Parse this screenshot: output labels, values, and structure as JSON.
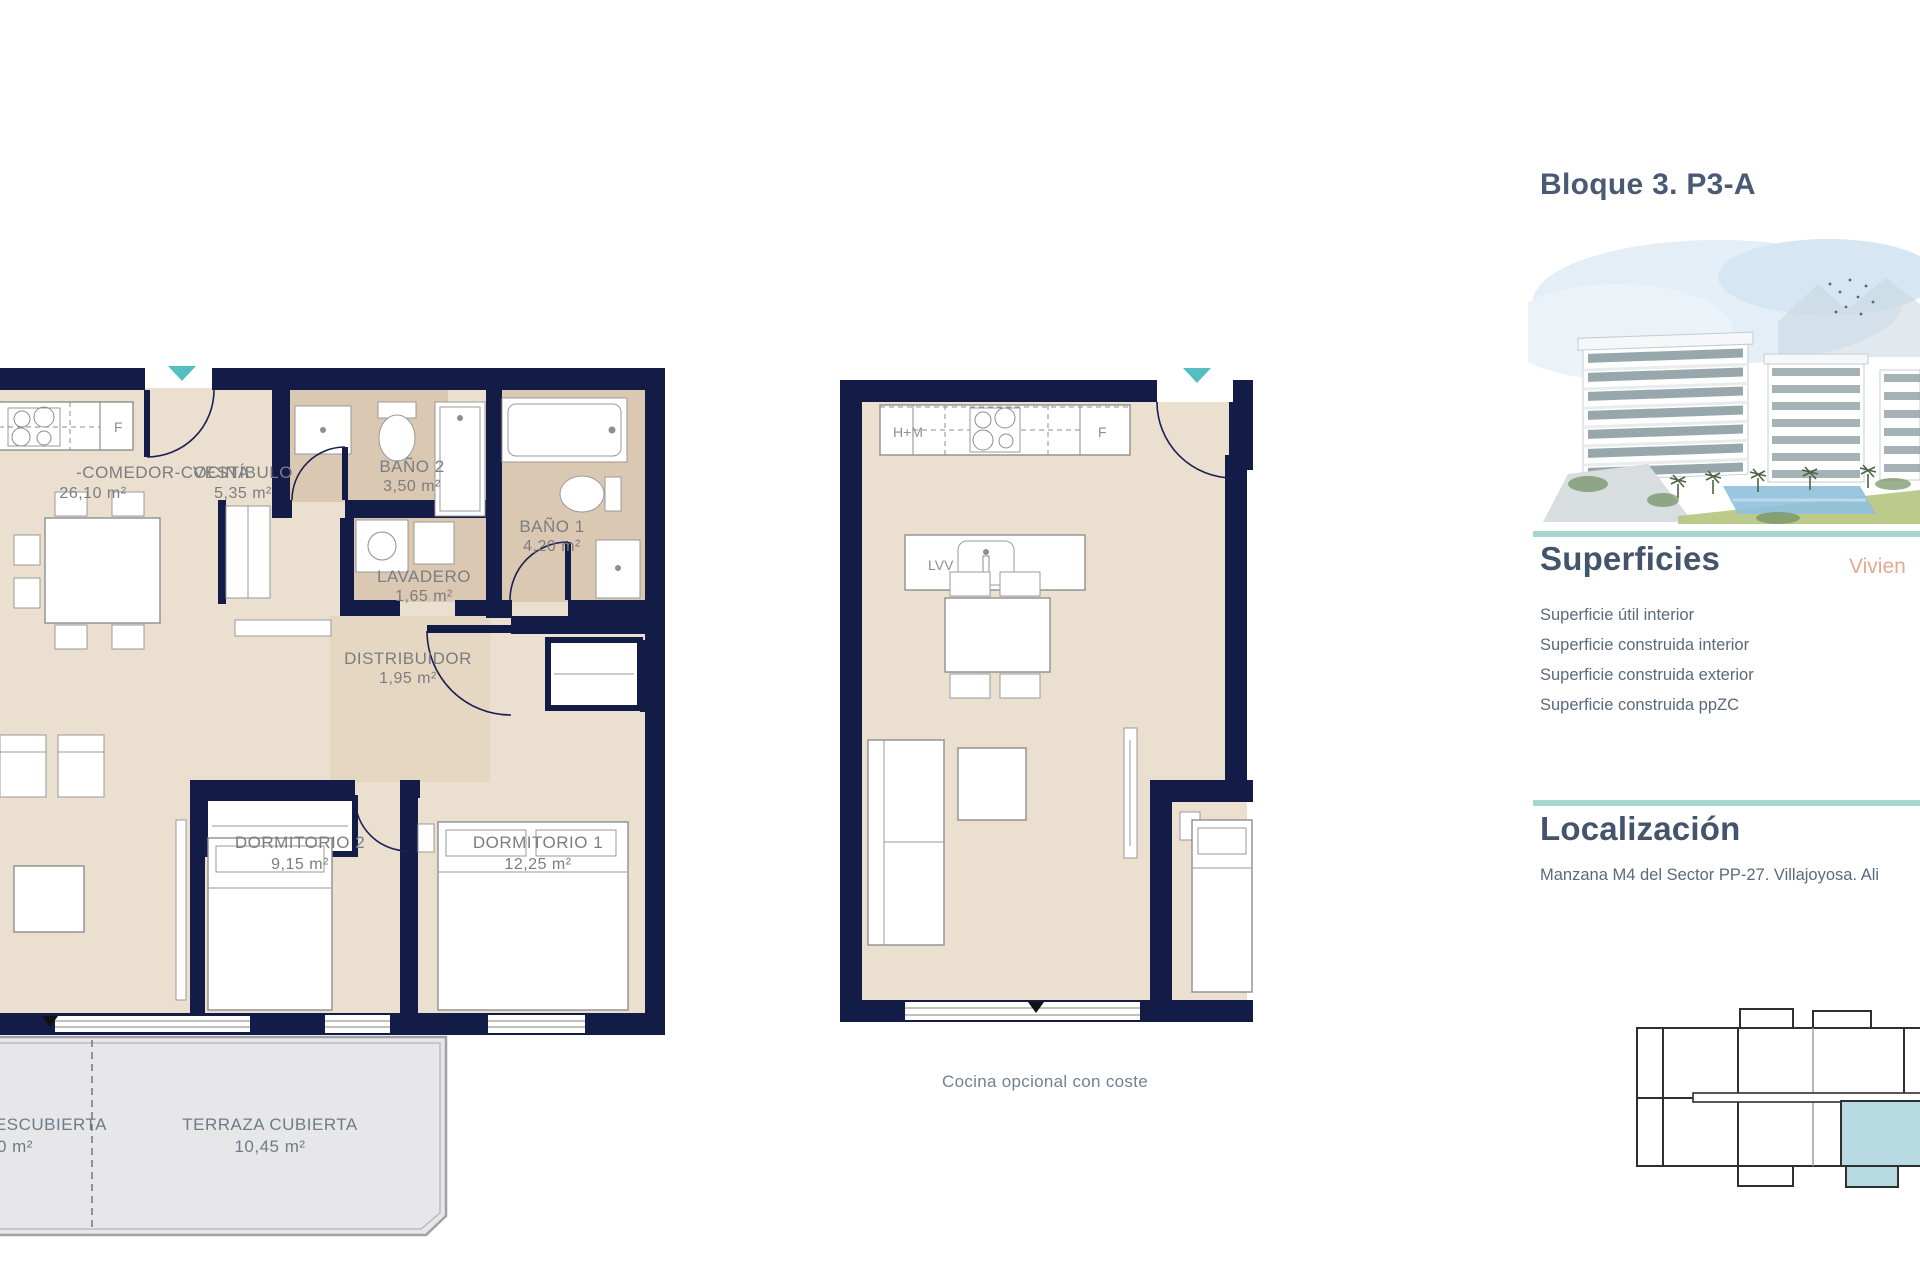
{
  "header": {
    "title": "Bloque 3. P3-A"
  },
  "superficies": {
    "heading": "Superficies",
    "vivienda_partial": "Vivien",
    "rows": [
      {
        "label": "Superficie útil interior"
      },
      {
        "label": "Superficie construida interior"
      },
      {
        "label": "Superficie construida exterior"
      },
      {
        "label": "Superficie construida ppZC"
      }
    ]
  },
  "localizacion": {
    "heading": "Localización",
    "text": "Manzana M4 del Sector PP-27. Villajoyosa. Ali"
  },
  "plan_a": {
    "rooms": {
      "salon": {
        "name": "-COMEDOR-COCINA",
        "area": "26,10 m²"
      },
      "vestibulo": {
        "name": "VESTÍBULO",
        "area": "5,35 m²"
      },
      "bano2": {
        "name": "BAÑO 2",
        "area": "3,50 m²"
      },
      "bano1": {
        "name": "BAÑO 1",
        "area": "4,20 m²"
      },
      "lavadero": {
        "name": "LAVADERO",
        "area": "1,65 m²"
      },
      "distribuidor": {
        "name": "DISTRIBUIDOR",
        "area": "1,95 m²"
      },
      "dormitorio2": {
        "name": "DORMITORIO 2",
        "area": "9,15 m²"
      },
      "dormitorio1": {
        "name": "DORMITORIO 1",
        "area": "12,25 m²"
      },
      "terraza_cubierta": {
        "name": "TERRAZA CUBIERTA",
        "area": "10,45 m²"
      },
      "terraza_descubierta": {
        "name": "ESCUBIERTA",
        "area": "0 m²"
      }
    },
    "labels": {
      "fridge": "F"
    }
  },
  "plan_b": {
    "labels": {
      "campana": "H+M",
      "fridge": "F",
      "dishwasher": "LVV"
    },
    "caption": "Cocina opcional con coste"
  },
  "colors": {
    "wall_navy": "#131b47",
    "floor_beige": "#ebdfcf",
    "floor_tan": "#dbc8b2",
    "terrace_gray": "#e7e6e8",
    "entry_arrow_teal": "#56bec0",
    "divider_teal": "#a5d6cf",
    "heading_slate": "#44546a",
    "accent_orange": "#e9a88d",
    "keyplan_highlight": "#b7dae3"
  }
}
